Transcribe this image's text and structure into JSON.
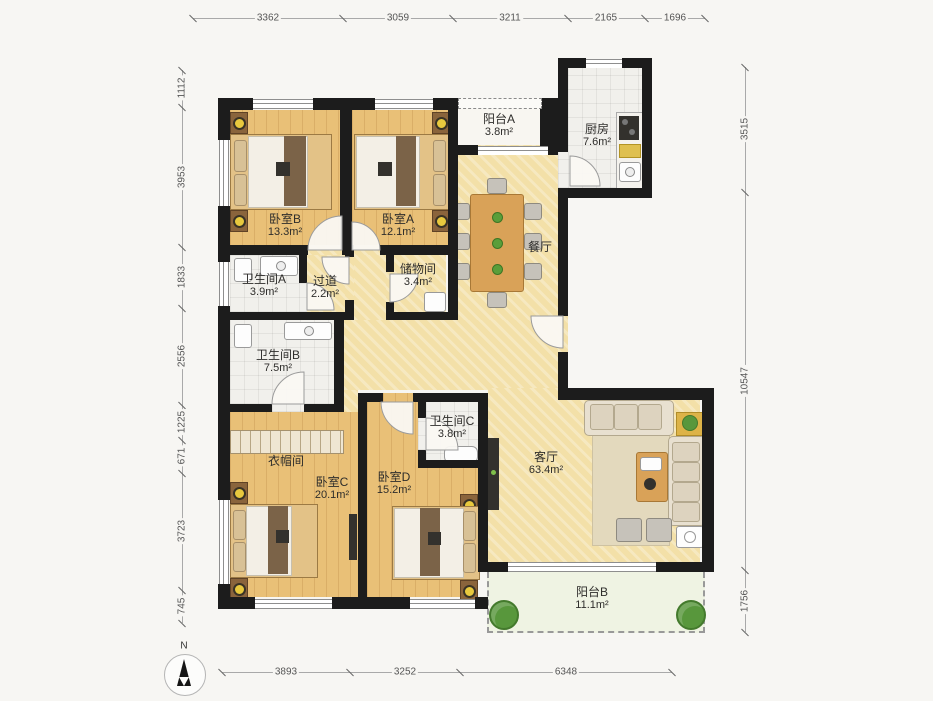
{
  "compass": {
    "north_label": "N"
  },
  "dimensions": {
    "top": [
      "3362",
      "3059",
      "3211",
      "2165",
      "1696"
    ],
    "left": [
      "1112",
      "3953",
      "1833",
      "2556",
      "1225",
      "671",
      "3723",
      "745"
    ],
    "right": [
      "3515",
      "10547",
      "1756"
    ],
    "bottom": [
      "3893",
      "3252",
      "6348"
    ]
  },
  "rooms": {
    "bedroom_b": {
      "name": "卧室B",
      "area": "13.3m²"
    },
    "bedroom_a": {
      "name": "卧室A",
      "area": "12.1m²"
    },
    "balcony_a": {
      "name": "阳台A",
      "area": "3.8m²"
    },
    "kitchen": {
      "name": "厨房",
      "area": "7.6m²"
    },
    "dining": {
      "name": "餐厅"
    },
    "bathroom_a": {
      "name": "卫生间A",
      "area": "3.9m²"
    },
    "hallway": {
      "name": "过道",
      "area": "2.2m²"
    },
    "storage": {
      "name": "储物间",
      "area": "3.4m²"
    },
    "bathroom_b": {
      "name": "卫生间B",
      "area": "7.5m²"
    },
    "cloakroom": {
      "name": "衣帽间"
    },
    "bedroom_c": {
      "name": "卧室C",
      "area": "20.1m²"
    },
    "bedroom_d": {
      "name": "卧室D",
      "area": "15.2m²"
    },
    "bathroom_c": {
      "name": "卫生间C",
      "area": "3.8m²"
    },
    "living": {
      "name": "客厅",
      "area": "63.4m²"
    },
    "balcony_b": {
      "name": "阳台B",
      "area": "11.1m²"
    }
  }
}
